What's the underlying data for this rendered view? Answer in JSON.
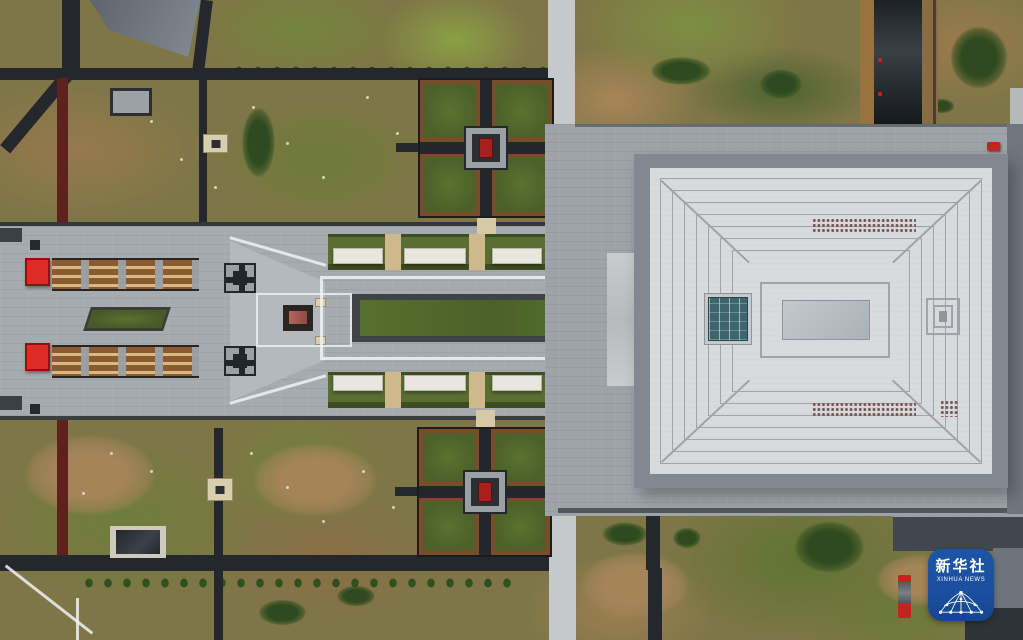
{
  "scene": {
    "type": "aerial-drone-photograph",
    "subject": "memorial park complex: axial gardens, red gates, cross-shaped parterres and a large grand-hall roof",
    "orientation": "top-down"
  },
  "watermark": {
    "cn": "新华社",
    "en": "XINHUA NEWS"
  },
  "palette": {
    "road_dark": "#24282c",
    "plaza_gray": "#a6abb0",
    "plaza_light": "#c7cacc",
    "roof_light": "#d8dadb",
    "roof_border": "#82888f",
    "ridge_line": "#9fa4aa",
    "lawn_green": "#55702e",
    "walkway_brown": "#8a5a33",
    "walkway_stripe": "#d9b97e",
    "gate_red": "#dd2b26",
    "pavilion_red": "#a8201d",
    "frame_rust": "#7b4c2a",
    "skylight_teal": "#3c656d",
    "maroon_path": "#5e211c",
    "vehicle_red": "#c1251d",
    "badge_blue": "#1a4f9e",
    "node_beige": "#d8cfae",
    "vent": "#7b565a"
  }
}
